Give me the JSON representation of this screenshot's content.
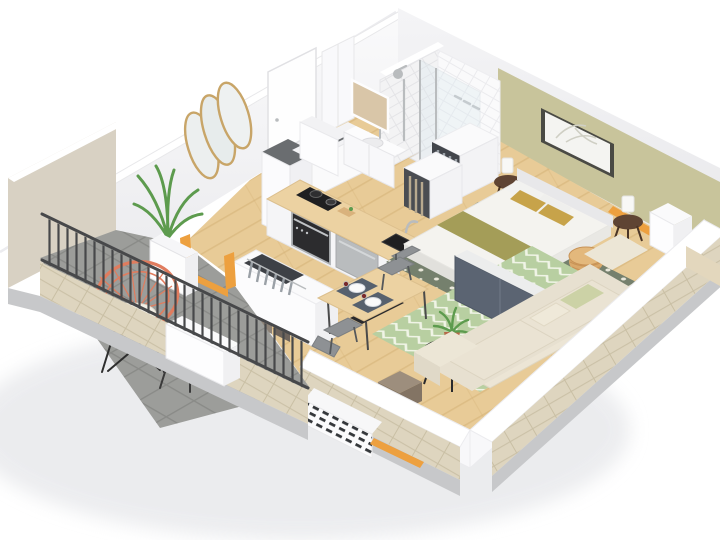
{
  "scene": {
    "title": "3D isometric cutaway floor plan of a studio apartment",
    "view": "axonometric bird's-eye, white background, near walls cut low, far walls full height",
    "rooms": [
      {
        "name": "balcony",
        "items": [
          "coral rattan lounge chair with white cushion",
          "round wooden side table with papers",
          "potted palm in white planter",
          "gray tile floor",
          "dark metal railing",
          "brick parapet",
          "white parapet box",
          "beige stucco side wall"
        ]
      },
      {
        "name": "entry-hall",
        "items": [
          "white entry door with handle",
          "gold triple-oval wall mirror",
          "low open wardrobe with hanging clothes and books",
          "dark doormat",
          "orange balcony door frame"
        ]
      },
      {
        "name": "kitchen",
        "items": [
          "tall white fridge cabinet with dark top",
          "white back cabinets with dark counter block",
          "wood countertop island",
          "black cooktop with two pots",
          "built-in oven",
          "black sink with chrome faucet",
          "stainless dishwasher front"
        ]
      },
      {
        "name": "bathroom",
        "items": [
          "white subway-tile shower walls",
          "glass shower screen",
          "chrome shower column and valves",
          "shower tray",
          "vanity with mirror and basin",
          "white storage cube",
          "tall white cabinet"
        ]
      },
      {
        "name": "bedroom",
        "items": [
          "double bed with white duvet",
          "mustard and white pillows",
          "olive throw blanket",
          "gray headboard strip",
          "dark sage rug with white lattice",
          "two dark wood tripod nightstands",
          "two white table lamps",
          "palm artwork in dark frame on olive accent wall",
          "open wardrobes with clothes",
          "gray bench panels at bed foot",
          "rattan pouf",
          "white low cabinet",
          "orange window frame"
        ]
      },
      {
        "name": "living-room",
        "items": [
          "cream three-seat sofa with cushions",
          "light green chevron rug",
          "black round coffee table",
          "plant in terracotta pot",
          "taupe pouf",
          "square wood dining table",
          "two gray dining chairs",
          "two place settings with plates and glasses",
          "white radiator with dark vents",
          "orange window frames",
          "dark window slit behind sofa"
        ]
      }
    ]
  },
  "colors": {
    "bg": "#ffffff",
    "shadow": "#e7e8eb",
    "wall": "#f8f8fa",
    "wall-shade": "#ededf0",
    "wall-top": "#ffffff",
    "olive-wall": "#c8c49b",
    "wood": "#e8cb97",
    "wood-line": "#d4b076",
    "counter": "#ecd2a2",
    "counter-edge": "#dcbf8d",
    "tile-gray": "#9c9d9a",
    "tile-line": "#8a8b88",
    "brick": "#ded5bf",
    "brick-line": "#c9bfa4",
    "slab": "#c7c8ca",
    "stucco": "#d8d1c3",
    "rug-dark": "#75806d",
    "rug-dot": "#e9e7da",
    "rug-light": "#b8cfa1",
    "rug-zig": "#f0f4e6",
    "sofa": "#e7e0d0",
    "sofa-shade": "#d9d0bc",
    "pillow-green": "#ccd2a6",
    "mustard": "#c7a34a",
    "olive-throw": "#a49d58",
    "duvet": "#f4f3ef",
    "panel-dark": "#5b6472",
    "panel-light": "#9aa2ab",
    "nightstand": "#5f4433",
    "lamp": "#f8f8f6",
    "rattan": "#d9a86a",
    "coral": "#e07c5e",
    "cushion": "#f2efe6",
    "side-table": "#e9c98f",
    "plant": "#5d9b4e",
    "terracotta": "#b56a4a",
    "taupe": "#8b7c6b",
    "chair-gray": "#8e9194",
    "placemat": "#57616e",
    "orange": "#eda03f",
    "rail": "#47484a",
    "black": "#1f1f21",
    "steel": "#b9bcbe",
    "glass": "#dce9ef",
    "gold": "#c8a568",
    "doormat": "#55575a",
    "window-dark": "#33353a",
    "cut-wood": "#e3d7bd"
  }
}
